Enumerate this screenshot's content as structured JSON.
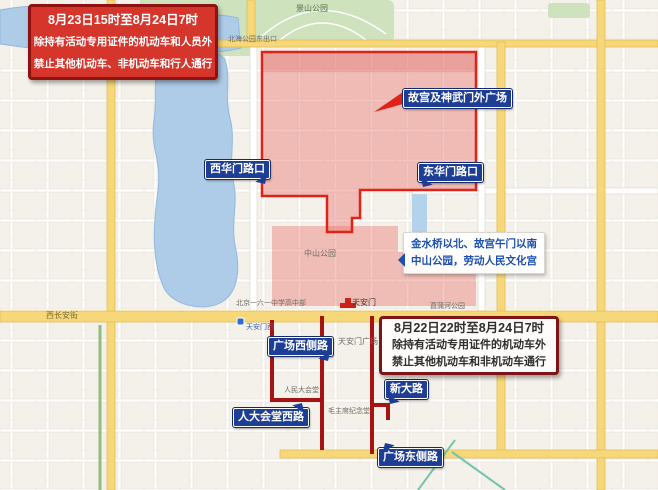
{
  "annotations": {
    "notice_top": {
      "lines": [
        "8月23日15时至8月24日7时",
        "除持有活动专用证件的机动车和人员外",
        "禁止其他机动车、非机动车和行人通行"
      ]
    },
    "notice_bottom": {
      "lines": [
        "8月22日22时至8月24日7时",
        "除持有活动专用证件的机动车外",
        "禁止其他机动车和非机动车通行"
      ]
    },
    "area_note": {
      "lines": [
        "金水桥以北、故宫午门以南",
        "中山公园，劳动人民文化宫"
      ]
    }
  },
  "road_signs": [
    {
      "label": "西华门路口"
    },
    {
      "label": "东华门路口"
    },
    {
      "label": "故宫及神武门外广场"
    },
    {
      "label": "广场西侧路"
    },
    {
      "label": "人大会堂西路"
    },
    {
      "label": "新大路"
    },
    {
      "label": "广场东侧路"
    }
  ],
  "map_labels": [
    {
      "text": "景山公园"
    },
    {
      "text": "北海公园东出口"
    },
    {
      "text": "西长安街"
    },
    {
      "text": "天安门西"
    },
    {
      "text": "天安门广场"
    },
    {
      "text": "中山公园"
    },
    {
      "text": "天安门"
    },
    {
      "text": "毛主席纪念堂"
    },
    {
      "text": "人民大会堂"
    },
    {
      "text": "北京一六一中学高中部"
    },
    {
      "text": "菖蒲河公园"
    }
  ],
  "colors": {
    "restricted_fill": "#e8716a",
    "restricted_border": "#e02318",
    "closed_road_line": "#a61313",
    "sign_blue": "#1e3e96",
    "notice_red": "#d6352b",
    "notice_border_dark": "#7e1416",
    "water": "#aecbe8",
    "park_green": "#cde2bd",
    "major_road_yellow": "#f6d87a"
  }
}
